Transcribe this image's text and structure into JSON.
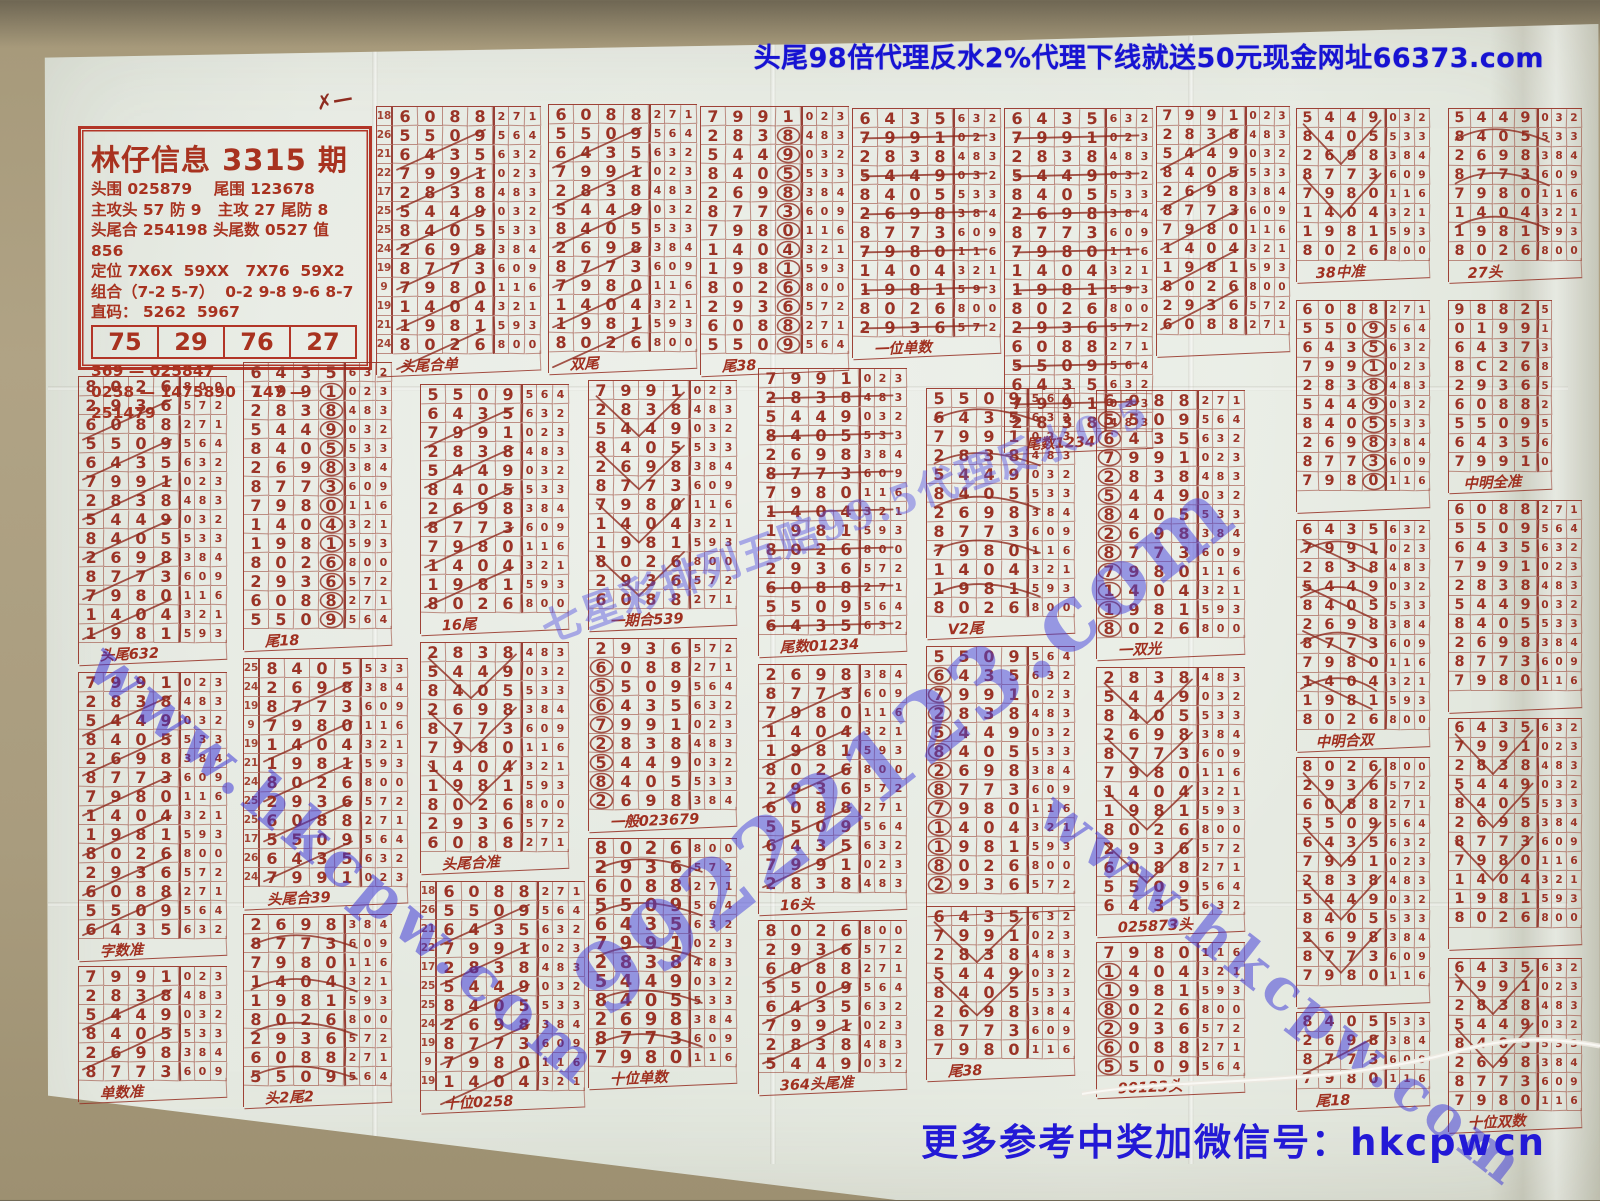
{
  "top_ad": {
    "text": "头尾98倍代理反水2%代理下线就送50元现金网址66373.com",
    "color": "#1713d2"
  },
  "bottom_contact": {
    "text": "更多参考中奖加微信号：hkcpwcn",
    "color": "#2319d6"
  },
  "watermarks": [
    {
      "id": "left-diagonal",
      "text": "www.hkcpw.com"
    },
    {
      "id": "right-diagonal",
      "text": "www.hkcpw.com"
    },
    {
      "id": "center-site",
      "text": "99222123.com"
    },
    {
      "id": "center-odds",
      "text": "七星彩排列五赔99.5代理反水0.5"
    }
  ],
  "header_card": {
    "title": "林仔信息 3315 期",
    "lines": [
      "头围 025879    尾围 123678",
      "主攻头 57 防 9   主攻 27 尾防 8",
      "头尾合 254198 头尾数 0527 值 856",
      "定位 7X6X  59XX   7X76  59X2",
      "组合（7-2 5-7）  0-2 9-8 9-6 8-7",
      "直码： 5262  5967"
    ],
    "quick_table": [
      "75",
      "29",
      "76",
      "27"
    ],
    "code_lines": [
      "369 — 025847",
      "0258 — 1475890   147 — 251479"
    ]
  },
  "scribble_mark": "✗—",
  "ink": {
    "red": "#9a3326",
    "stroke": "rgba(143,42,30,0.8)",
    "print_red": "#b23527"
  },
  "grid_base": {
    "rows": [
      [
        "8",
        "0",
        "2",
        "6",
        "8",
        "0",
        "0"
      ],
      [
        "2",
        "9",
        "3",
        "6",
        "5",
        "7",
        "2"
      ],
      [
        "6",
        "0",
        "8",
        "8",
        "2",
        "7",
        "1"
      ],
      [
        "5",
        "5",
        "0",
        "9",
        "5",
        "6",
        "4"
      ],
      [
        "6",
        "4",
        "3",
        "5",
        "6",
        "3",
        "2"
      ],
      [
        "7",
        "9",
        "9",
        "1",
        "0",
        "2",
        "3"
      ],
      [
        "2",
        "8",
        "3",
        "8",
        "4",
        "8",
        "3"
      ],
      [
        "5",
        "4",
        "4",
        "9",
        "0",
        "3",
        "2"
      ],
      [
        "8",
        "4",
        "0",
        "5",
        "5",
        "3",
        "3"
      ],
      [
        "2",
        "6",
        "9",
        "8",
        "3",
        "8",
        "4"
      ],
      [
        "8",
        "7",
        "7",
        "3",
        "6",
        "0",
        "9"
      ],
      [
        "7",
        "9",
        "8",
        "0",
        "1",
        "1",
        "6"
      ],
      [
        "1",
        "4",
        "0",
        "4",
        "3",
        "2",
        "1"
      ],
      [
        "1",
        "9",
        "8",
        "1",
        "5",
        "9",
        "3"
      ]
    ],
    "alt_rows": [
      [
        "9",
        "8",
        "8",
        "2",
        "5"
      ],
      [
        "0",
        "1",
        "9",
        "9",
        "1"
      ],
      [
        "6",
        "4",
        "3",
        "7",
        "3"
      ],
      [
        "8",
        "C",
        "2",
        "6",
        "8"
      ],
      [
        "2",
        "9",
        "3",
        "6",
        "5"
      ],
      [
        "6",
        "0",
        "8",
        "8",
        "2"
      ],
      [
        "5",
        "5",
        "0",
        "9",
        "5"
      ],
      [
        "6",
        "4",
        "3",
        "5",
        "6"
      ],
      [
        "7",
        "9",
        "9",
        "1",
        "0"
      ]
    ],
    "index_values": [
      "22",
      "19",
      "18",
      "26",
      "21",
      "22",
      "17",
      "25",
      "25",
      "24",
      "19",
      "9",
      "19",
      "21",
      "24",
      "25",
      "25",
      "17",
      "26",
      "24",
      "9",
      "10",
      "23",
      "19",
      "18",
      "26",
      "21",
      "19"
    ]
  },
  "grids": [
    {
      "x": 376,
      "y": 106,
      "rows": 13,
      "start": 2,
      "idx": 1,
      "deco": "slash",
      "label": "头尾合单"
    },
    {
      "x": 548,
      "y": 104,
      "rows": 13,
      "start": 2,
      "idx": 0,
      "deco": "slash",
      "label": "双尾"
    },
    {
      "x": 700,
      "y": 106,
      "rows": 13,
      "start": 5,
      "idx": 0,
      "deco": "circle",
      "label": "尾38"
    },
    {
      "x": 852,
      "y": 108,
      "rows": 12,
      "start": 4,
      "idx": 0,
      "deco": "strike",
      "label": "一位单数"
    },
    {
      "x": 1004,
      "y": 108,
      "rows": 17,
      "start": 4,
      "idx": 0,
      "deco": "strike",
      "label": "尾数1234"
    },
    {
      "x": 1156,
      "y": 106,
      "rows": 12,
      "start": 5,
      "idx": 0,
      "compact": 1,
      "deco": "slash",
      "label": ""
    },
    {
      "x": 1296,
      "y": 108,
      "rows": 8,
      "start": 7,
      "idx": 0,
      "compact": 1,
      "deco": "vee",
      "label": "38中准"
    },
    {
      "x": 1448,
      "y": 108,
      "rows": 8,
      "start": 7,
      "idx": 0,
      "compact": 1,
      "deco": "arc",
      "label": "27头"
    },
    {
      "x": 1448,
      "y": 300,
      "rows": 9,
      "start": 0,
      "idx": 0,
      "compact": 1,
      "alt": 1,
      "deco": "none",
      "label": "中明全准"
    },
    {
      "x": 1296,
      "y": 300,
      "rows": 10,
      "start": 2,
      "idx": 0,
      "compact": 1,
      "deco": "circle",
      "label": ""
    },
    {
      "x": 78,
      "y": 376,
      "rows": 14,
      "start": 0,
      "idx": 0,
      "deco": "slash",
      "label": "头尾632"
    },
    {
      "x": 243,
      "y": 362,
      "rows": 14,
      "start": 4,
      "idx": 0,
      "deco": "circle",
      "label": "尾18"
    },
    {
      "x": 420,
      "y": 384,
      "rows": 12,
      "start": 3,
      "idx": 0,
      "deco": "slash",
      "label": "16尾"
    },
    {
      "x": 588,
      "y": 380,
      "rows": 12,
      "start": 5,
      "idx": 0,
      "deco": "vee",
      "label": "一期合539"
    },
    {
      "x": 758,
      "y": 368,
      "rows": 14,
      "start": 5,
      "idx": 0,
      "deco": "strike",
      "label": "尾数01234"
    },
    {
      "x": 926,
      "y": 388,
      "rows": 12,
      "start": 3,
      "idx": 0,
      "deco": "arc",
      "label": "V2尾"
    },
    {
      "x": 1096,
      "y": 390,
      "rows": 13,
      "start": 2,
      "idx": 0,
      "deco": "circleL",
      "label": "一双光"
    },
    {
      "x": 1296,
      "y": 520,
      "rows": 11,
      "start": 4,
      "idx": 0,
      "compact": 1,
      "deco": "net",
      "label": "中明合双"
    },
    {
      "x": 1448,
      "y": 500,
      "rows": 10,
      "start": 2,
      "idx": 0,
      "compact": 1,
      "deco": "none",
      "label": ""
    },
    {
      "x": 78,
      "y": 672,
      "rows": 14,
      "start": 5,
      "idx": 0,
      "deco": "slash",
      "label": "字数准"
    },
    {
      "x": 243,
      "y": 658,
      "rows": 12,
      "start": 8,
      "idx": 1,
      "deco": "slash",
      "label": "头尾合39"
    },
    {
      "x": 420,
      "y": 642,
      "rows": 11,
      "start": 6,
      "idx": 0,
      "deco": "vee",
      "label": "头尾合准"
    },
    {
      "x": 588,
      "y": 638,
      "rows": 9,
      "start": 1,
      "idx": 0,
      "deco": "circleL",
      "label": "一般023679"
    },
    {
      "x": 758,
      "y": 664,
      "rows": 12,
      "start": 9,
      "idx": 0,
      "deco": "slash",
      "label": "16头"
    },
    {
      "x": 926,
      "y": 646,
      "rows": 13,
      "start": 3,
      "idx": 0,
      "deco": "circleL",
      "label": ""
    },
    {
      "x": 1096,
      "y": 667,
      "rows": 13,
      "start": 6,
      "idx": 0,
      "deco": "vee",
      "label": "025873头"
    },
    {
      "x": 1296,
      "y": 757,
      "rows": 12,
      "start": 0,
      "idx": 0,
      "compact": 1,
      "deco": "vee",
      "label": ""
    },
    {
      "x": 1448,
      "y": 718,
      "rows": 11,
      "start": 4,
      "idx": 0,
      "compact": 1,
      "deco": "vee",
      "label": ""
    },
    {
      "x": 78,
      "y": 966,
      "rows": 6,
      "start": 5,
      "idx": 0,
      "deco": "slash",
      "label": "单数准"
    },
    {
      "x": 243,
      "y": 914,
      "rows": 9,
      "start": 9,
      "idx": 0,
      "deco": "arc",
      "label": "头2尾2"
    },
    {
      "x": 420,
      "y": 881,
      "rows": 11,
      "start": 2,
      "idx": 1,
      "deco": "slash",
      "label": "十位0258"
    },
    {
      "x": 588,
      "y": 838,
      "rows": 12,
      "start": 0,
      "idx": 0,
      "bold": 1,
      "deco": "arc",
      "label": "十位单数"
    },
    {
      "x": 758,
      "y": 920,
      "rows": 8,
      "start": 0,
      "idx": 0,
      "deco": "slash",
      "label": "364头尾准"
    },
    {
      "x": 926,
      "y": 906,
      "rows": 8,
      "start": 4,
      "idx": 0,
      "deco": "vee",
      "label": "尾38"
    },
    {
      "x": 1096,
      "y": 942,
      "rows": 7,
      "start": 11,
      "idx": 0,
      "deco": "circleL",
      "label": "90123头"
    },
    {
      "x": 1296,
      "y": 1012,
      "rows": 4,
      "start": 8,
      "idx": 0,
      "compact": 1,
      "deco": "slash",
      "label": "尾18"
    },
    {
      "x": 1448,
      "y": 958,
      "rows": 8,
      "start": 4,
      "idx": 0,
      "compact": 1,
      "deco": "vee",
      "label": "十位双数"
    }
  ]
}
